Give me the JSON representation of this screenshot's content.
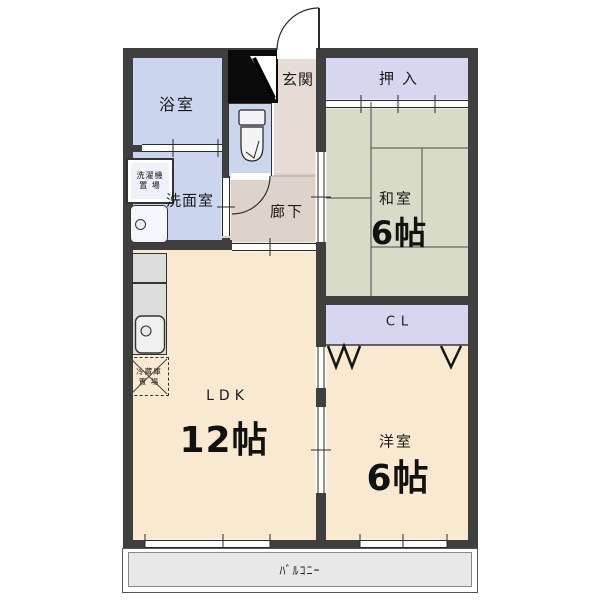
{
  "plan_title": "apartment-floor-plan",
  "rooms": {
    "bath": {
      "label": "浴室"
    },
    "washroom": {
      "label": "洗面室"
    },
    "genkan": {
      "label": "玄関"
    },
    "hallway": {
      "label": "廊下"
    },
    "oshiire": {
      "label": "押入"
    },
    "washitsu": {
      "label": "和室",
      "size": "6帖"
    },
    "closet": {
      "label": "CL"
    },
    "ldk": {
      "label": "LDK",
      "size": "12帖"
    },
    "youshitsu": {
      "label": "洋室",
      "size": "6帖"
    },
    "balcony": {
      "label": "ﾊﾞﾙｺﾆｰ"
    }
  },
  "fixtures": {
    "washer": {
      "label_line1": "洗濯機",
      "label_line2": "置 場"
    },
    "fridge": {
      "label_line1": "冷蔵庫",
      "label_line2": "置 場"
    },
    "icons": [
      "shoe-cabinet-icon",
      "toilet-icon",
      "washbasin-icon",
      "kitchen-sink-icon",
      "door-swing-icon",
      "sliding-door-icon",
      "folding-door-icon",
      "window-icon"
    ]
  },
  "colors": {
    "wall": "#3f3f3f",
    "water-room": "#cbd5ee",
    "closet": "#d7d6f0",
    "tatami": "#d8dbc8",
    "western-room": "#f8e9d0",
    "hall": "#ded3ca",
    "genkan": "#e7ddd6",
    "balcony": "#e8e8e8",
    "counter": "#dcdcdc",
    "outline": "#2a2a2a"
  }
}
